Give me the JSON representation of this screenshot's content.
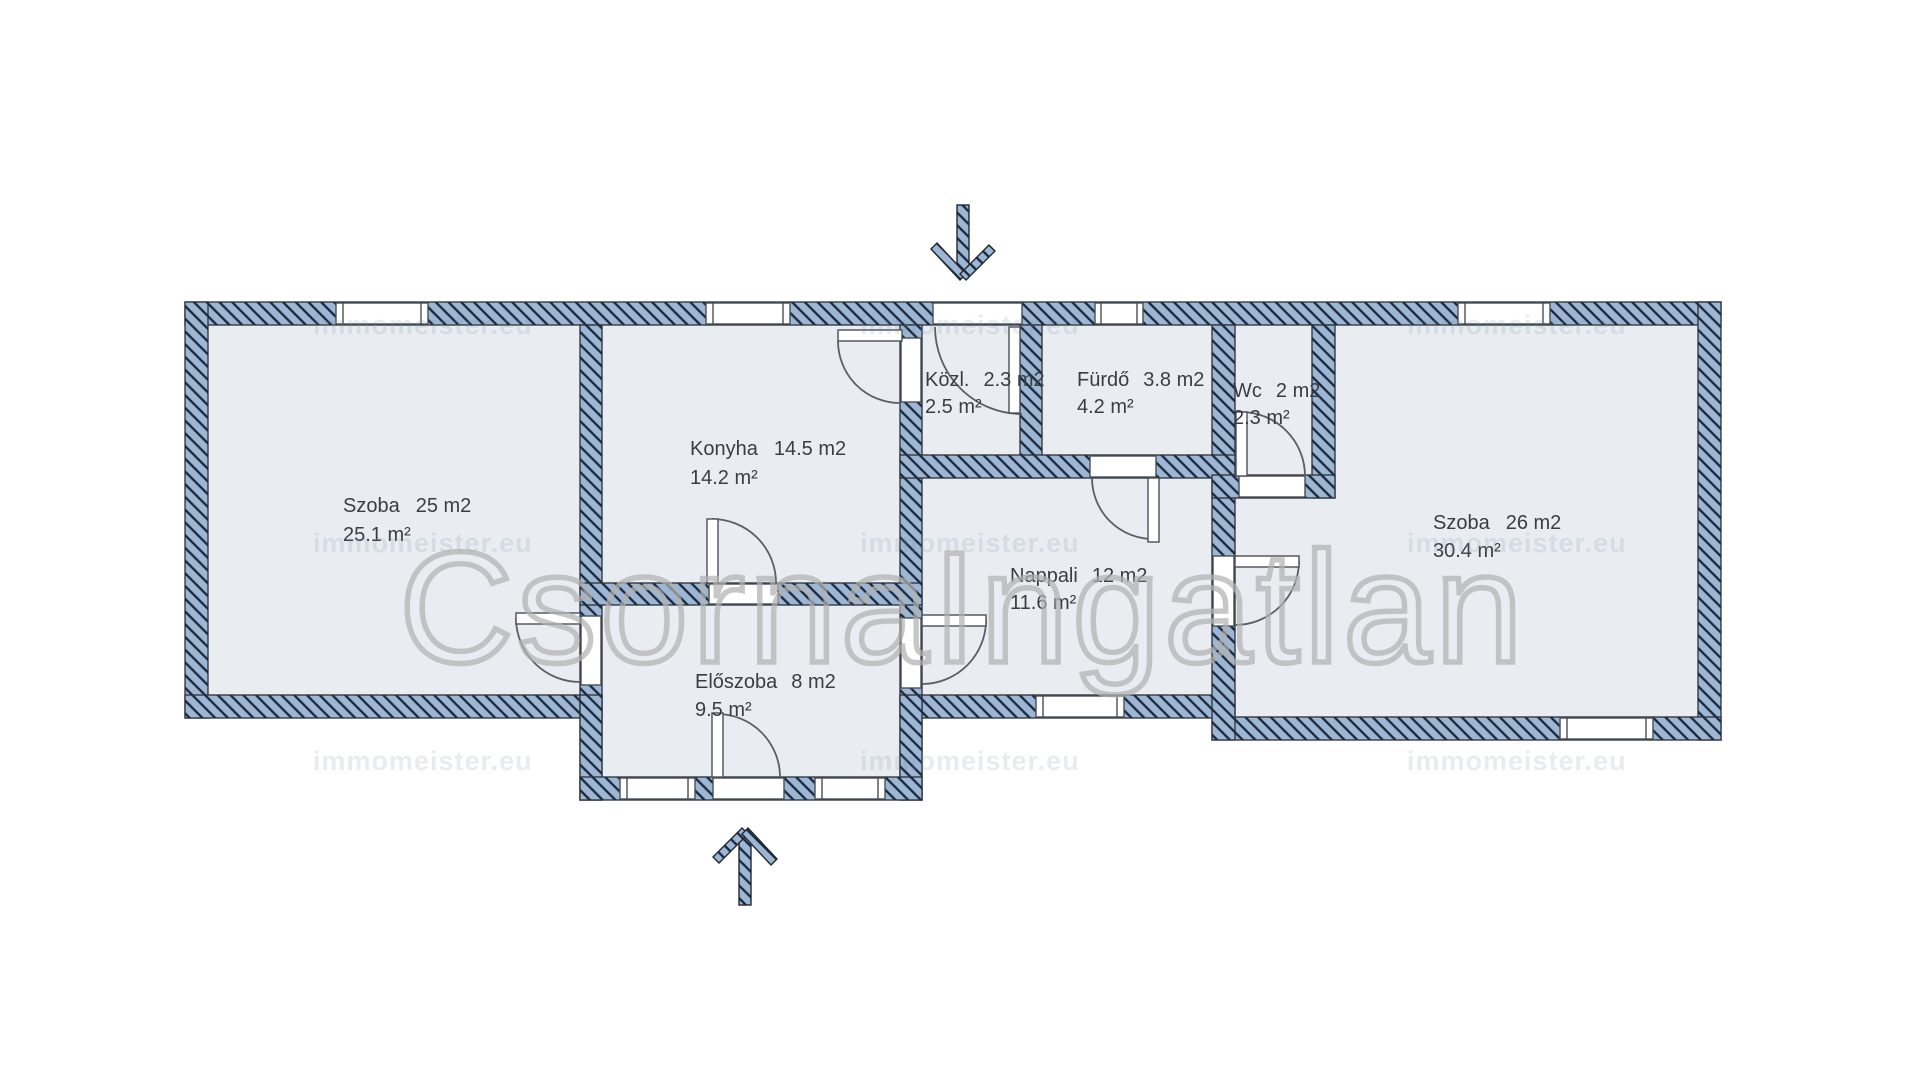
{
  "floorplan": {
    "rooms": [
      {
        "name": "Szoba",
        "size": "25 m2",
        "area": "25.1 m²"
      },
      {
        "name": "Konyha",
        "size": "14.5 m2",
        "area": "14.2 m²"
      },
      {
        "name": "Közl.",
        "size": "2.3 m2",
        "area": "2.5 m²"
      },
      {
        "name": "Fürdő",
        "size": "3.8 m2",
        "area": "4.2 m²"
      },
      {
        "name": "Wc",
        "size": "2 m2",
        "area": "2.3 m²"
      },
      {
        "name": "Nappali",
        "size": "12 m2",
        "area": "11.6 m²"
      },
      {
        "name": "Előszoba",
        "size": "8 m2",
        "area": "9.5 m²"
      },
      {
        "name": "Szoba",
        "size": "26 m2",
        "area": "30.4 m²"
      }
    ],
    "watermark": {
      "brand": "CsornaIngatlan",
      "tile": "immomeister.eu"
    },
    "colors": {
      "wall_fill": "#9cb6d4",
      "wall_hatch": "#18273c",
      "floor": "#e9edf1",
      "background": "#ffffff",
      "label": "#3a3d42",
      "watermark": "#b2b2b2"
    }
  }
}
